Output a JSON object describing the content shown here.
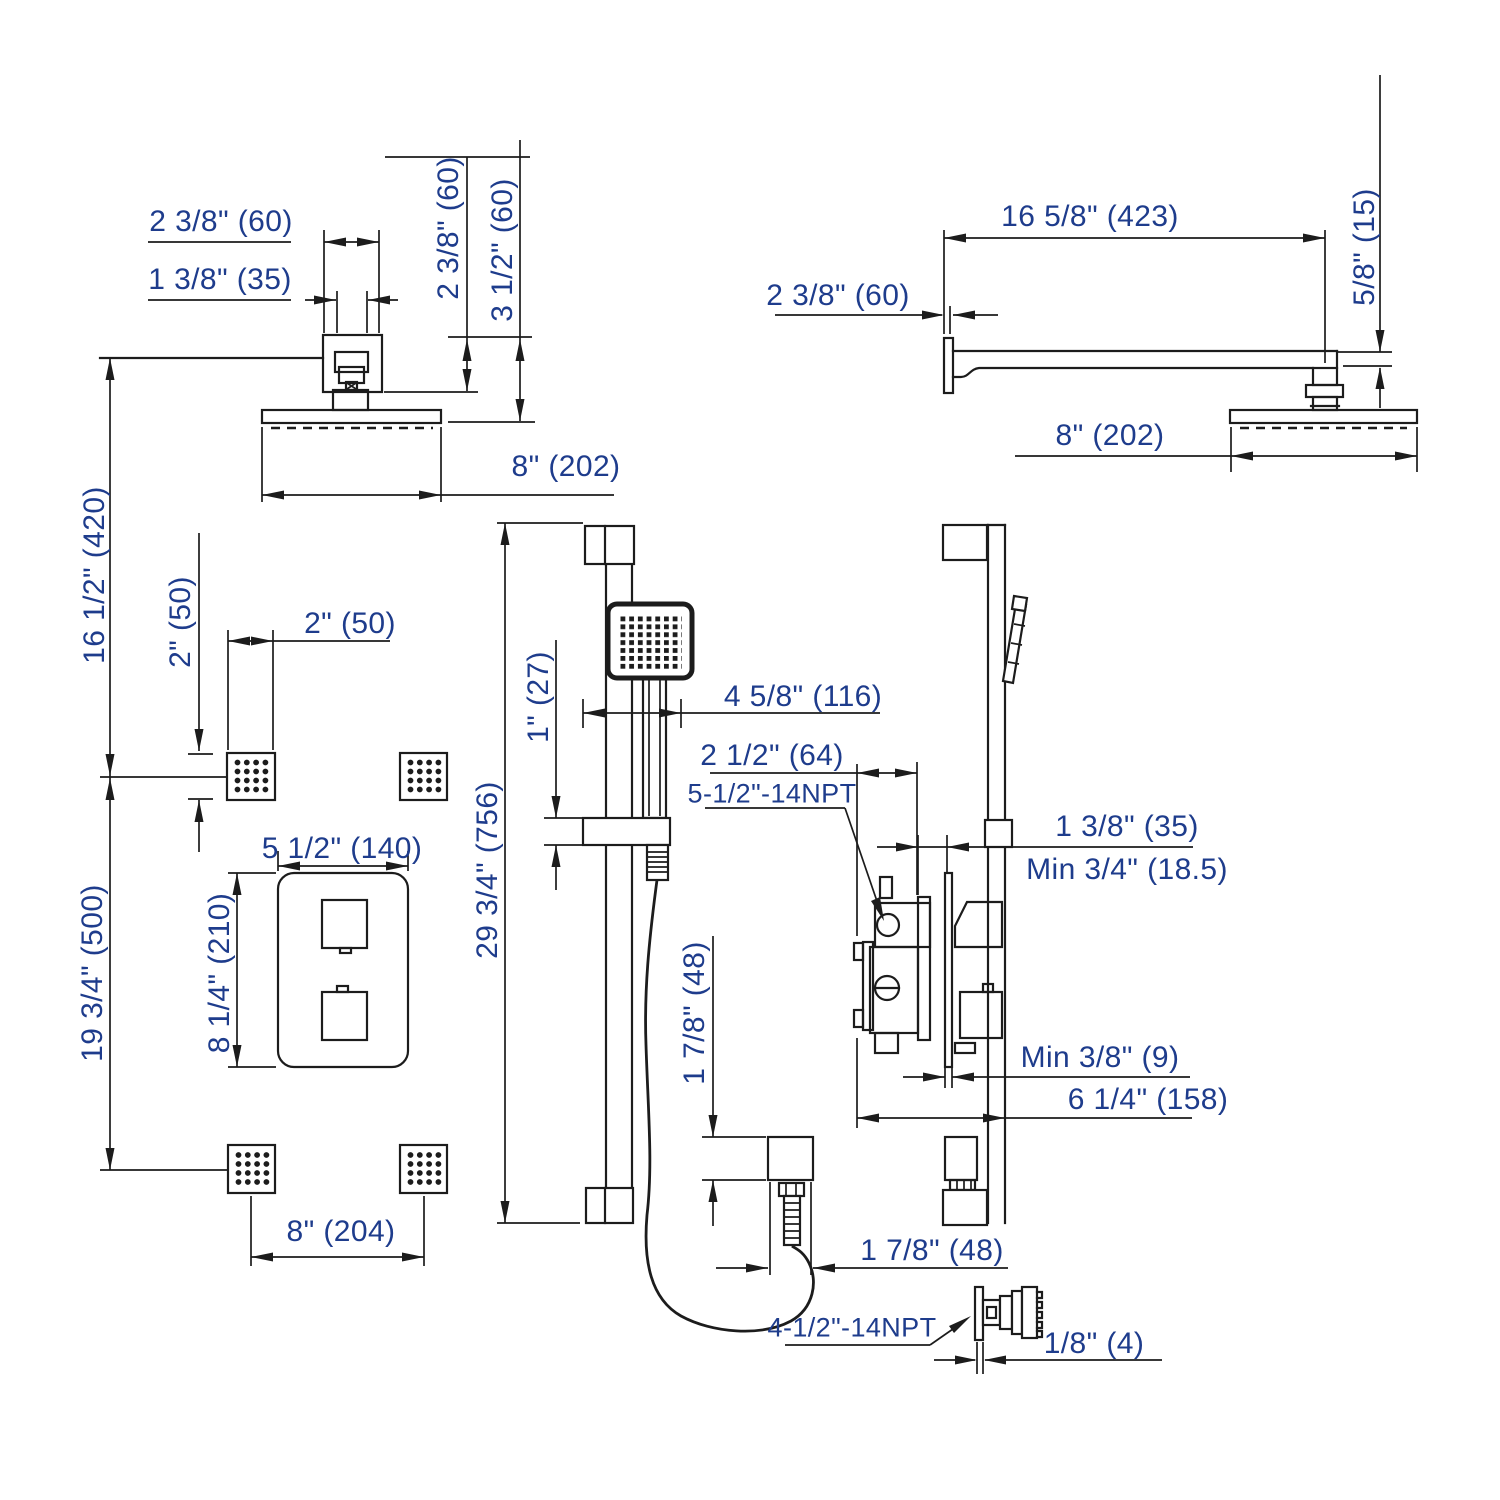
{
  "colors": {
    "dimension_text": "#1e3c8c",
    "linework": "#1c1c1c",
    "background": "#ffffff"
  },
  "views": {
    "showerhead_front": {
      "dims": {
        "escutcheon_width": "2 3/8\" (60)",
        "arm_neck_width": "1 3/8\" (35)",
        "escutcheon_drop": "2 3/8\" (60)",
        "head_drop": "3 1/2\" (60)",
        "head_width": "8\" (202)"
      }
    },
    "showerhead_side": {
      "dims": {
        "arm_length": "16 5/8\" (423)",
        "wall_flange": "2 3/8\" (60)",
        "arm_thickness": "5/8\" (15)",
        "head_width": "8\" (202)"
      }
    },
    "system_front": {
      "dims": {
        "head_to_upper_jets": "16 1/2\" (420)",
        "upper_to_lower_jets": "19 3/4\" (500)",
        "jet_height": "2\" (50)",
        "jet_width": "2\" (50)",
        "valve_plate_width": "5 1/2\" (140)",
        "valve_plate_height": "8 1/4\" (210)",
        "lower_jet_spacing": "8\" (204)",
        "slide_bar_length": "29 3/4\" (756)"
      }
    },
    "slidebar_front": {
      "dims": {
        "bar_diameter": "1\" (27)",
        "handshower_offset": "4 5/8\" (116)",
        "outlet_height": "1 7/8\" (48)",
        "outlet_width": "1 7/8\" (48)"
      }
    },
    "valve_side": {
      "dims": {
        "valve_depth": "2 1/2\" (64)",
        "inlet_thread": "5-1/2\"-14NPT",
        "bar_wall_offset": "1 3/8\" (35)",
        "min_wall_thickness": "Min 3/4\" (18.5)",
        "min_plate_gap": "Min 3/8\" (9)",
        "valve_to_bar": "6 1/4\" (158)"
      }
    },
    "body_jet_side": {
      "dims": {
        "jet_thread": "4-1/2\"-14NPT",
        "jet_standoff": "1/8\" (4)"
      }
    }
  }
}
